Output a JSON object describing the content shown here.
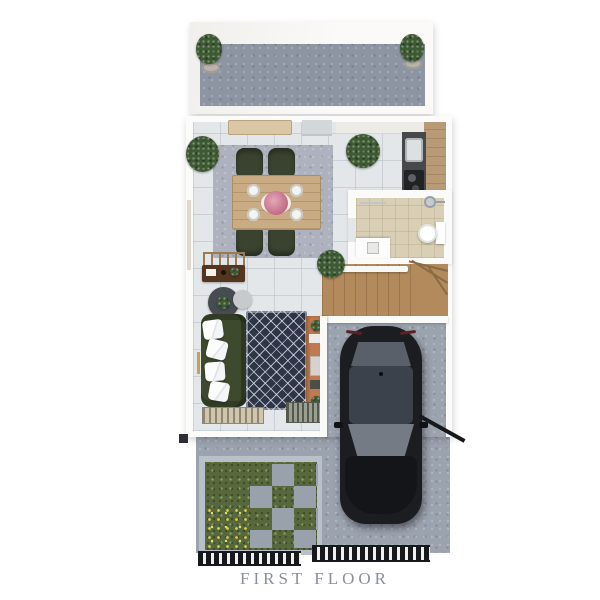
{
  "title": {
    "caption": "FIRST FLOOR"
  },
  "colors": {
    "caption_text": "#8b8f99",
    "terrace_floor": "#8d95a3",
    "interior_tile": "#e3e7ea",
    "dining_rug": "#adb2be",
    "table_wood": "#c9ac83",
    "chair_green": "#3a432f",
    "sideboard_wood": "#d9c7a6",
    "kitchen_counter": "#46484a",
    "kitchen_wood": "#b89b76",
    "bathroom_floor": "#d9cfb5",
    "stairs_wood": "#b28a5c",
    "living_rug": "#2e3547",
    "sofa_green": "#3e4a2d",
    "tv_wall": "#c07a4e",
    "console_wood": "#54351f",
    "garage_floor": "#9ba3af",
    "car_body": "#1b1d21",
    "car_roof": "#3c424c",
    "grass": "#57683c",
    "flowers": "#d8c84a",
    "paver": "#98a1ac",
    "gate": "#17181c",
    "plant_green": "#3e5a33"
  },
  "scene": {
    "areas": [
      "terrace",
      "dining-area",
      "kitchen",
      "bathroom",
      "staircase",
      "living-area",
      "garage",
      "garden",
      "driveway"
    ],
    "objects": [
      "potted-plants",
      "dining-table-with-four-chairs",
      "sideboard",
      "kitchen-sink",
      "stove",
      "wall-cabinets",
      "toilet",
      "vanity-sink",
      "shower-head",
      "towel-bar",
      "sofa-with-pillows",
      "poufs",
      "console-table",
      "ladder-decor",
      "tv-wall-unit",
      "door-mats",
      "black-car",
      "grass-lawn",
      "stepping-stones",
      "entry-gates"
    ]
  }
}
